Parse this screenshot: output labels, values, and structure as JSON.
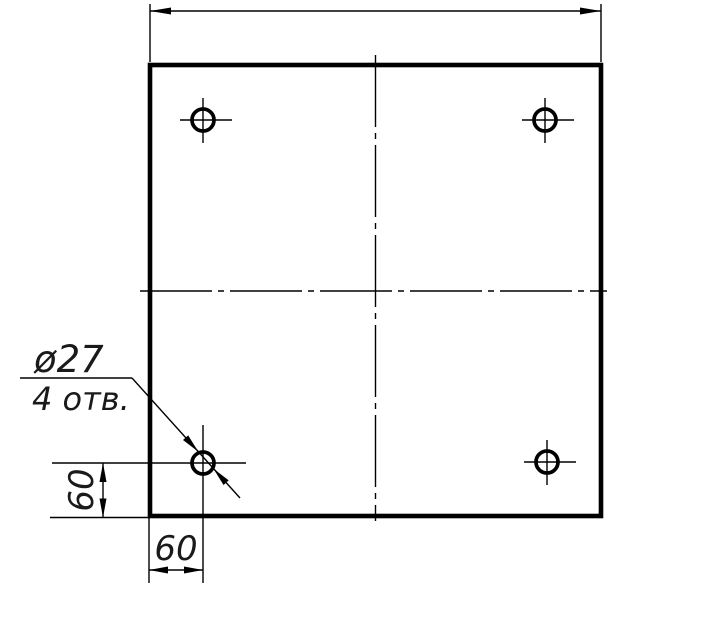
{
  "meta": {
    "background_color": "#ffffff",
    "line_color": "#000000",
    "drawing_kind": "technical-drawing"
  },
  "drawing": {
    "part": "square plate with four holes",
    "labels": {
      "hole_diameter": "ø27",
      "hole_count": "4 отв.",
      "dim_hole_offset_vertical": "60",
      "dim_hole_offset_horizontal": "60"
    }
  }
}
